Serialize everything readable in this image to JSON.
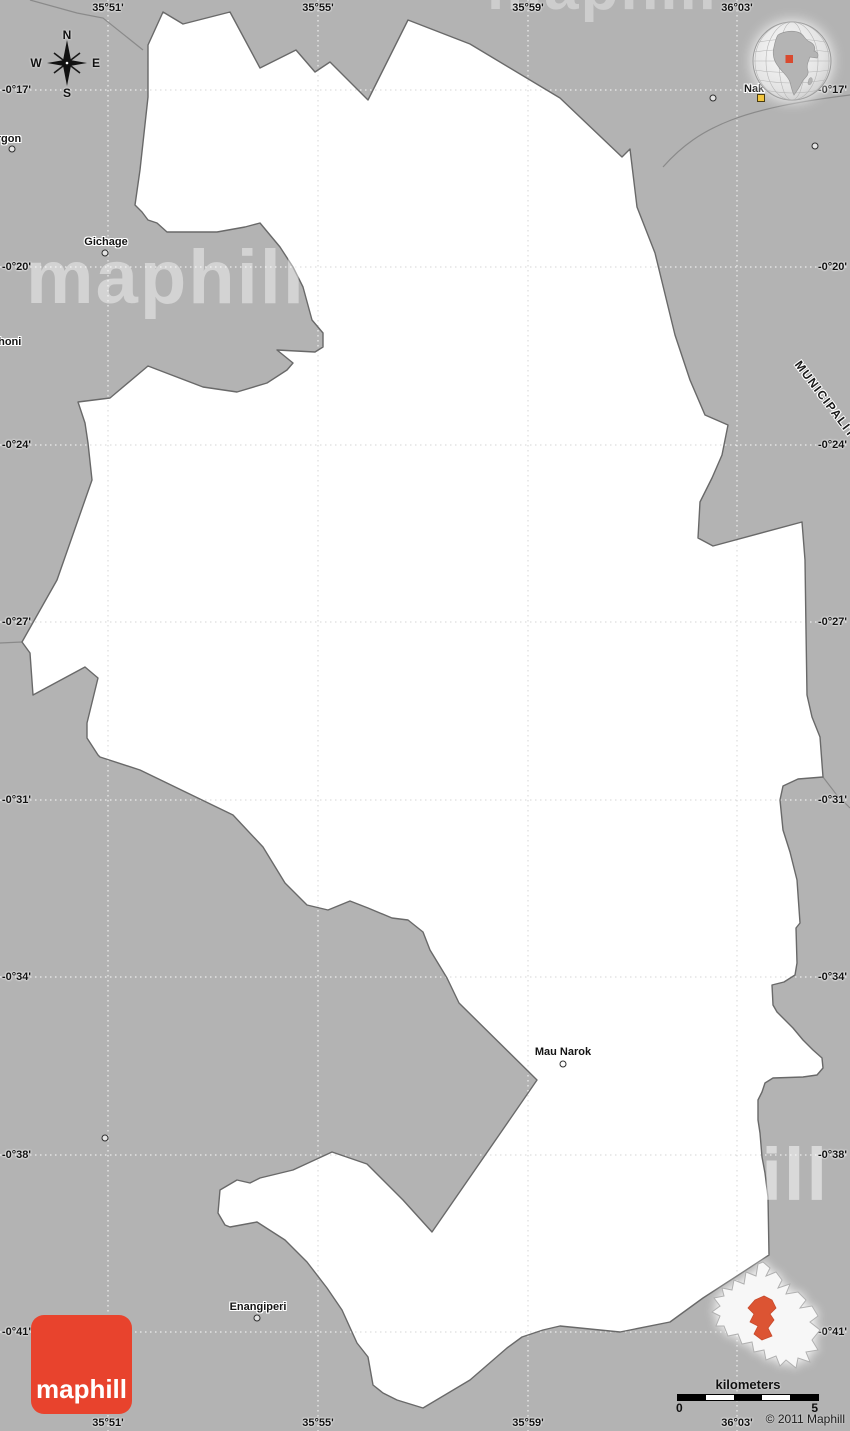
{
  "coordinates": {
    "lon_labels": [
      "35°51'",
      "35°55'",
      "35°59'",
      "36°03'"
    ],
    "lat_labels": [
      "-0°17'",
      "-0°20'",
      "-0°24'",
      "-0°27'",
      "-0°31'",
      "-0°34'",
      "-0°38'",
      "-0°41'"
    ]
  },
  "places": {
    "urgon": "urgon",
    "gichage": "Gichage",
    "shoni": "shoni",
    "nakuru": "Nak",
    "mau_narok": "Mau Narok",
    "enangiperi": "Enangiperi",
    "municipality": "MUNICIPALITY"
  },
  "compass": {
    "north": "N",
    "south": "S",
    "east": "E",
    "west": "W"
  },
  "watermark": {
    "text": "maphill"
  },
  "logo": {
    "text": "maphill"
  },
  "scale_bar": {
    "title": "kilometers",
    "start_label": "0",
    "end_label": "5"
  },
  "copyright": "© 2011 Maphill",
  "colors": {
    "background_gray": "#b3b3b3",
    "region_fill": "#ffffff",
    "boundary_gray": "#666666",
    "logo_red": "#e8432d",
    "inset_highlight_red": "#dc5433",
    "city_marker_yellow": "#f2c53d"
  }
}
